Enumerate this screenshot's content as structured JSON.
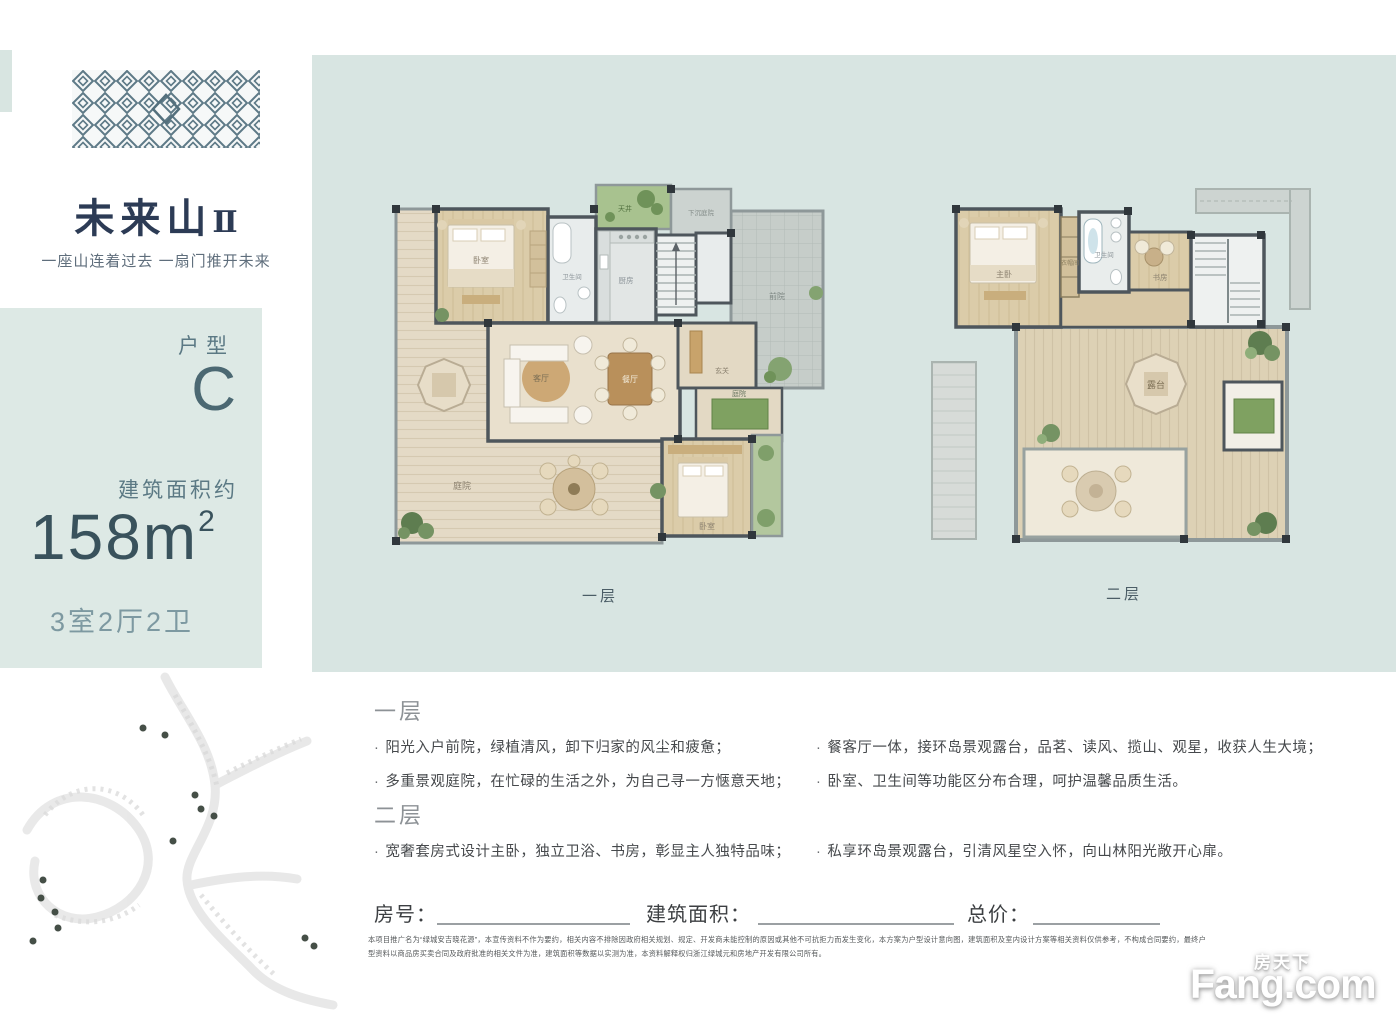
{
  "brand": {
    "name": "未来山",
    "name_suffix": "Ⅱ",
    "tagline": "一座山连着过去 一扇门推开未来"
  },
  "unit": {
    "type_label": "户型",
    "type_value": "C",
    "area_label": "建筑面积约",
    "area_value": "158m",
    "area_sup": "2",
    "rooms_summary": "3室2厅2卫"
  },
  "floorplans": {
    "floor1": {
      "caption": "一层",
      "rooms": {
        "bedroom": "卧室",
        "bath": "卫生间",
        "kitchen": "厨房",
        "patio": "天井",
        "sunken_patio": "下沉庭院",
        "front_yard": "前院",
        "living": "客厅",
        "dining": "餐厅",
        "entry": "玄关",
        "courtyard": "庭院",
        "bedroom2": "卧室",
        "terrace": "庭院"
      }
    },
    "floor2": {
      "caption": "二层",
      "rooms": {
        "master": "主卧",
        "closet": "衣帽间",
        "bath": "卫生间",
        "study": "书房",
        "terrace": "露台"
      }
    }
  },
  "features": {
    "bullet_char": "·",
    "floor1_title": "一层",
    "floor1_bullets_left": [
      "阳光入户前院，绿植清风，卸下归家的风尘和疲惫；",
      "多重景观庭院，在忙碌的生活之外，为自己寻一方惬意天地；"
    ],
    "floor1_bullets_right": [
      "餐客厅一体，接环岛景观露台，品茗、读风、揽山、观星，收获人生大境；",
      "卧室、卫生间等功能区分布合理，呵护温馨品质生活。"
    ],
    "floor2_title": "二层",
    "floor2_bullets_left": [
      "宽奢套房式设计主卧，独立卫浴、书房，彰显主人独特品味；"
    ],
    "floor2_bullets_right": [
      "私享环岛景观露台，引清风星空入怀，向山林阳光敞开心扉。"
    ]
  },
  "form": {
    "room_no_label": "房号：",
    "area_label": "建筑面积：",
    "price_label": "总价："
  },
  "disclaimer": "本项目推广名为“绿城安吉晓花源”，本宣传资料不作为要约，相关内容不排除因政府相关规划、规定、开发商未能控制的原因或其他不可抗拒力而发生变化，本方案为户型设计意向图，建筑面积及室内设计方案等相关资料仅供参考，不构成合同要约，最终户型资料以商品房买卖合同及政府批准的相关文件为准，建筑面积等数据以实测为准，本资料解释权归浙江绿城元和房地产开发有限公司所有。",
  "watermark": {
    "cn": "房天下",
    "en": "Fang.com"
  },
  "colors": {
    "panel": "#d8e5e2",
    "sidebar": "#dde9e5",
    "brand_navy": "#2c3b55",
    "spec_teal": "#39525c"
  }
}
